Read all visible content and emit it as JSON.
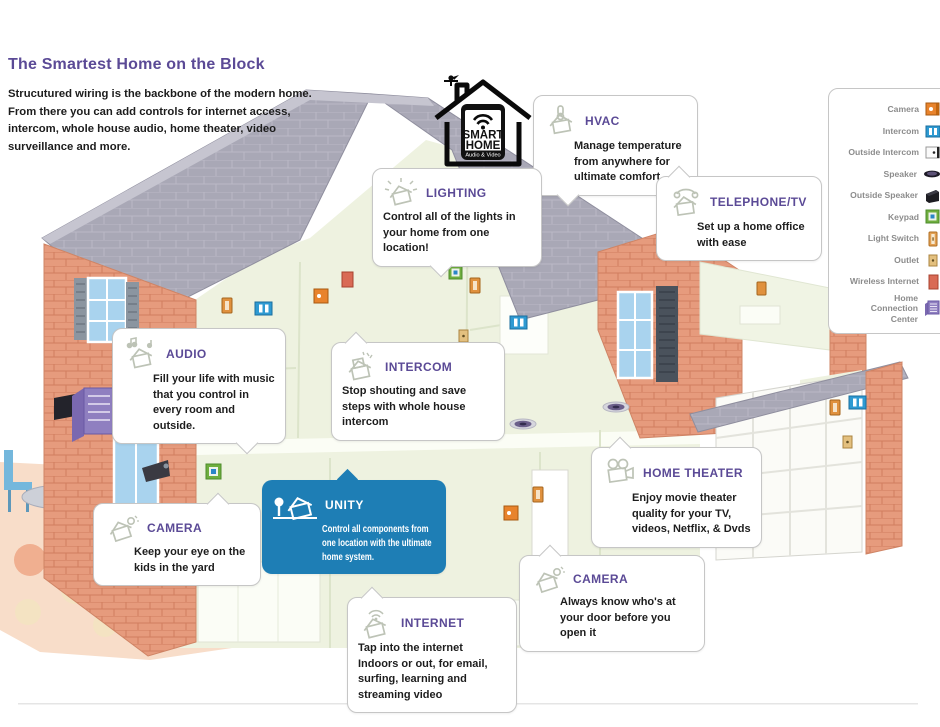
{
  "page": {
    "title": "The Smartest Home on the Block",
    "intro": "Strucutured wiring is the backbone of the modern home. From there you can add controls for internet access, intercom, whole house audio, home theater, video surveillance and more."
  },
  "logo": {
    "line1": "SMART",
    "line2": "HOME",
    "banner": "Audio & Video"
  },
  "colors": {
    "accent_purple": "#5b4a96",
    "unity_blue": "#1e7eb5",
    "roof_gray": "#a9a8b6",
    "brick": "#e69b7d",
    "interior_green": "#eef2e0",
    "bubble_border": "#c6c6c6",
    "legend_text": "#8c8c8c"
  },
  "callouts": [
    {
      "id": "hvac",
      "title": "HVAC",
      "text": "Manage temperature from anywhere for ultimate comfort",
      "icon": "thermostat-house-icon"
    },
    {
      "id": "lighting",
      "title": "LIGHTING",
      "text": "Control all of the lights in your home from one location!",
      "icon": "lighting-house-icon"
    },
    {
      "id": "telephone-tv",
      "title": "TELEPHONE/TV",
      "text": "Set up a home office with ease",
      "icon": "telephone-house-icon"
    },
    {
      "id": "audio",
      "title": "AUDIO",
      "text": "Fill your life with music that you control in every room and outside.",
      "icon": "audio-house-icon"
    },
    {
      "id": "intercom",
      "title": "INTERCOM",
      "text": "Stop shouting and save steps with whole house intercom",
      "icon": "intercom-house-icon"
    },
    {
      "id": "unity",
      "title": "UNITY",
      "text": "Control all components from one location with the ultimate home system.",
      "icon": "unity-house-icon"
    },
    {
      "id": "camera-yard",
      "title": "CAMERA",
      "text": "Keep your eye on the kids in the yard",
      "icon": "camera-house-icon"
    },
    {
      "id": "home-theater",
      "title": "HOME THEATER",
      "text": "Enjoy movie theater quality for your TV, videos, Netflix, & Dvds",
      "icon": "movie-camera-icon"
    },
    {
      "id": "camera-door",
      "title": "CAMERA",
      "text": "Always know who's at your door before you open it",
      "icon": "camera-house-icon"
    },
    {
      "id": "internet",
      "title": "INTERNET",
      "text": "Tap into the internet Indoors or out, for email, surfing, learning and streaming video",
      "icon": "wifi-house-icon"
    }
  ],
  "legend": {
    "items": [
      {
        "label": "Camera",
        "icon": "camera-icon"
      },
      {
        "label": "Intercom",
        "icon": "intercom-icon"
      },
      {
        "label": "Outside Intercom",
        "icon": "outside-intercom-icon"
      },
      {
        "label": "Speaker",
        "icon": "speaker-icon"
      },
      {
        "label": "Outside Speaker",
        "icon": "outside-speaker-icon"
      },
      {
        "label": "Keypad",
        "icon": "keypad-icon"
      },
      {
        "label": "Light Switch",
        "icon": "light-switch-icon"
      },
      {
        "label": "Outlet",
        "icon": "outlet-icon"
      },
      {
        "label": "Wireless Internet",
        "icon": "wireless-internet-icon"
      },
      {
        "label": "Home Connection Center",
        "icon": "home-connection-center-icon"
      }
    ]
  }
}
